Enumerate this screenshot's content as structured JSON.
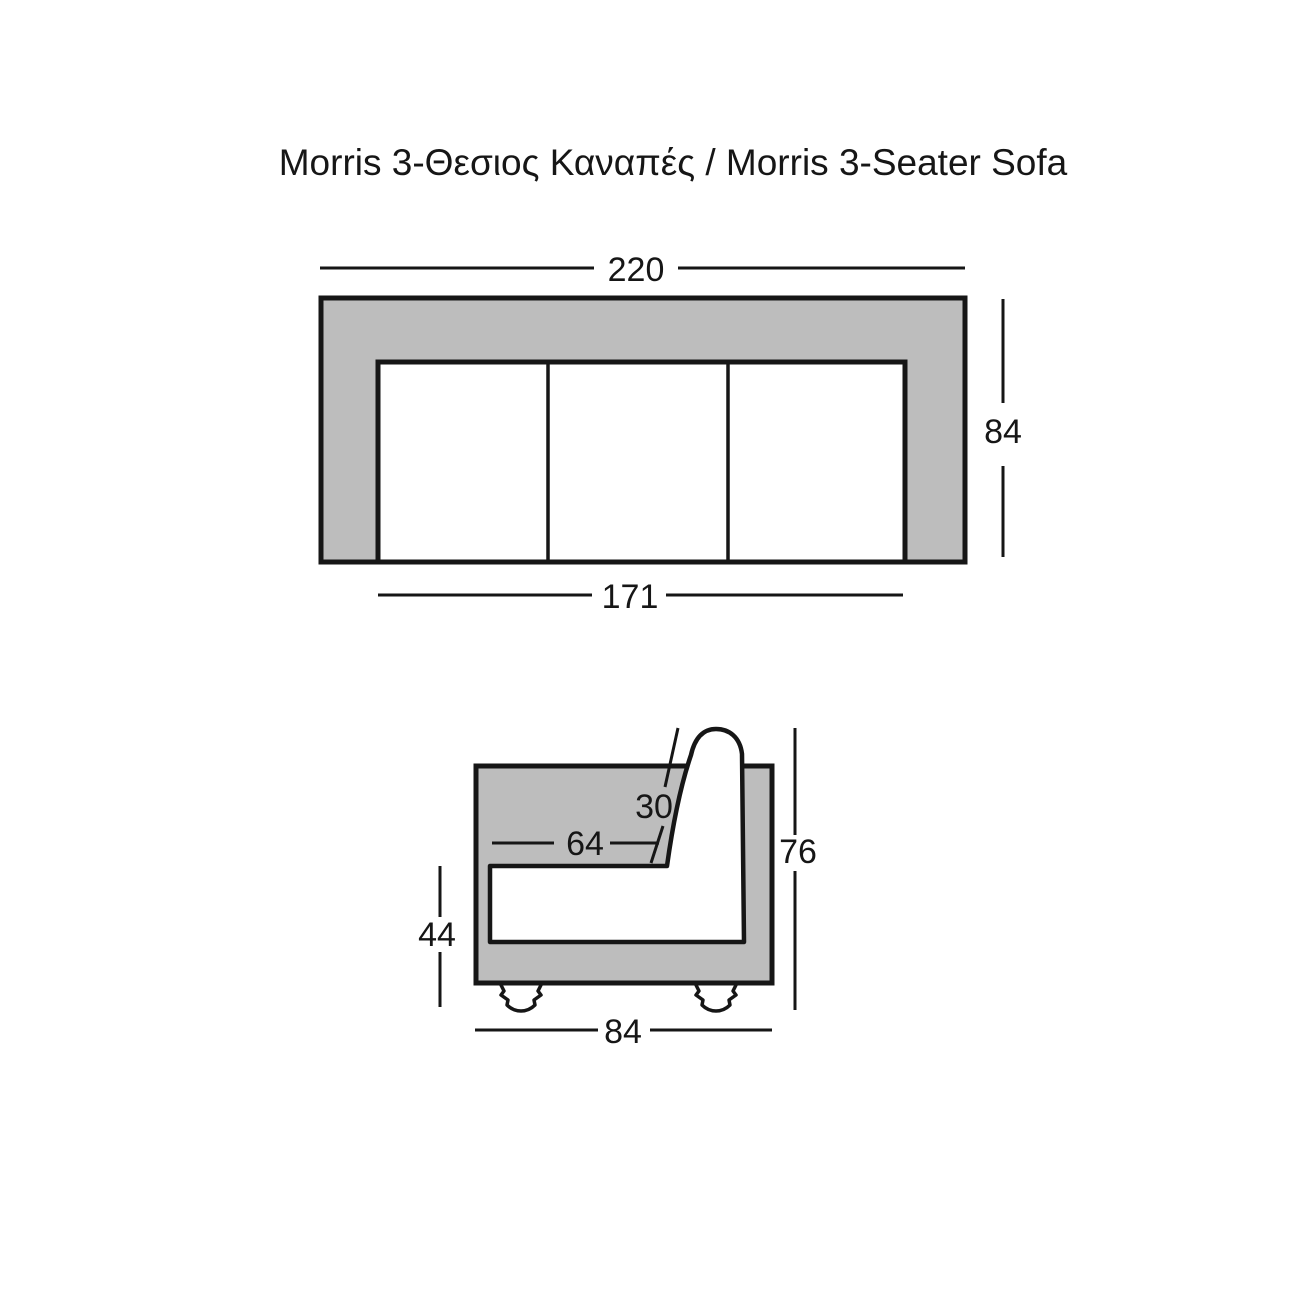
{
  "title": "Morris 3-Θεσιος Καναπές / Morris 3-Seater Sofa",
  "colors": {
    "sofa_fill": "#bdbdbd",
    "line": "#161616",
    "background": "#ffffff"
  },
  "top_view": {
    "seat_count": 3,
    "dims": {
      "overall_width": "220",
      "overall_depth": "84",
      "seat_width": "171"
    }
  },
  "side_view": {
    "dims": {
      "backrest_thickness": "30",
      "seat_depth": "64",
      "overall_height": "76",
      "seat_height": "44",
      "overall_depth": "84"
    }
  }
}
